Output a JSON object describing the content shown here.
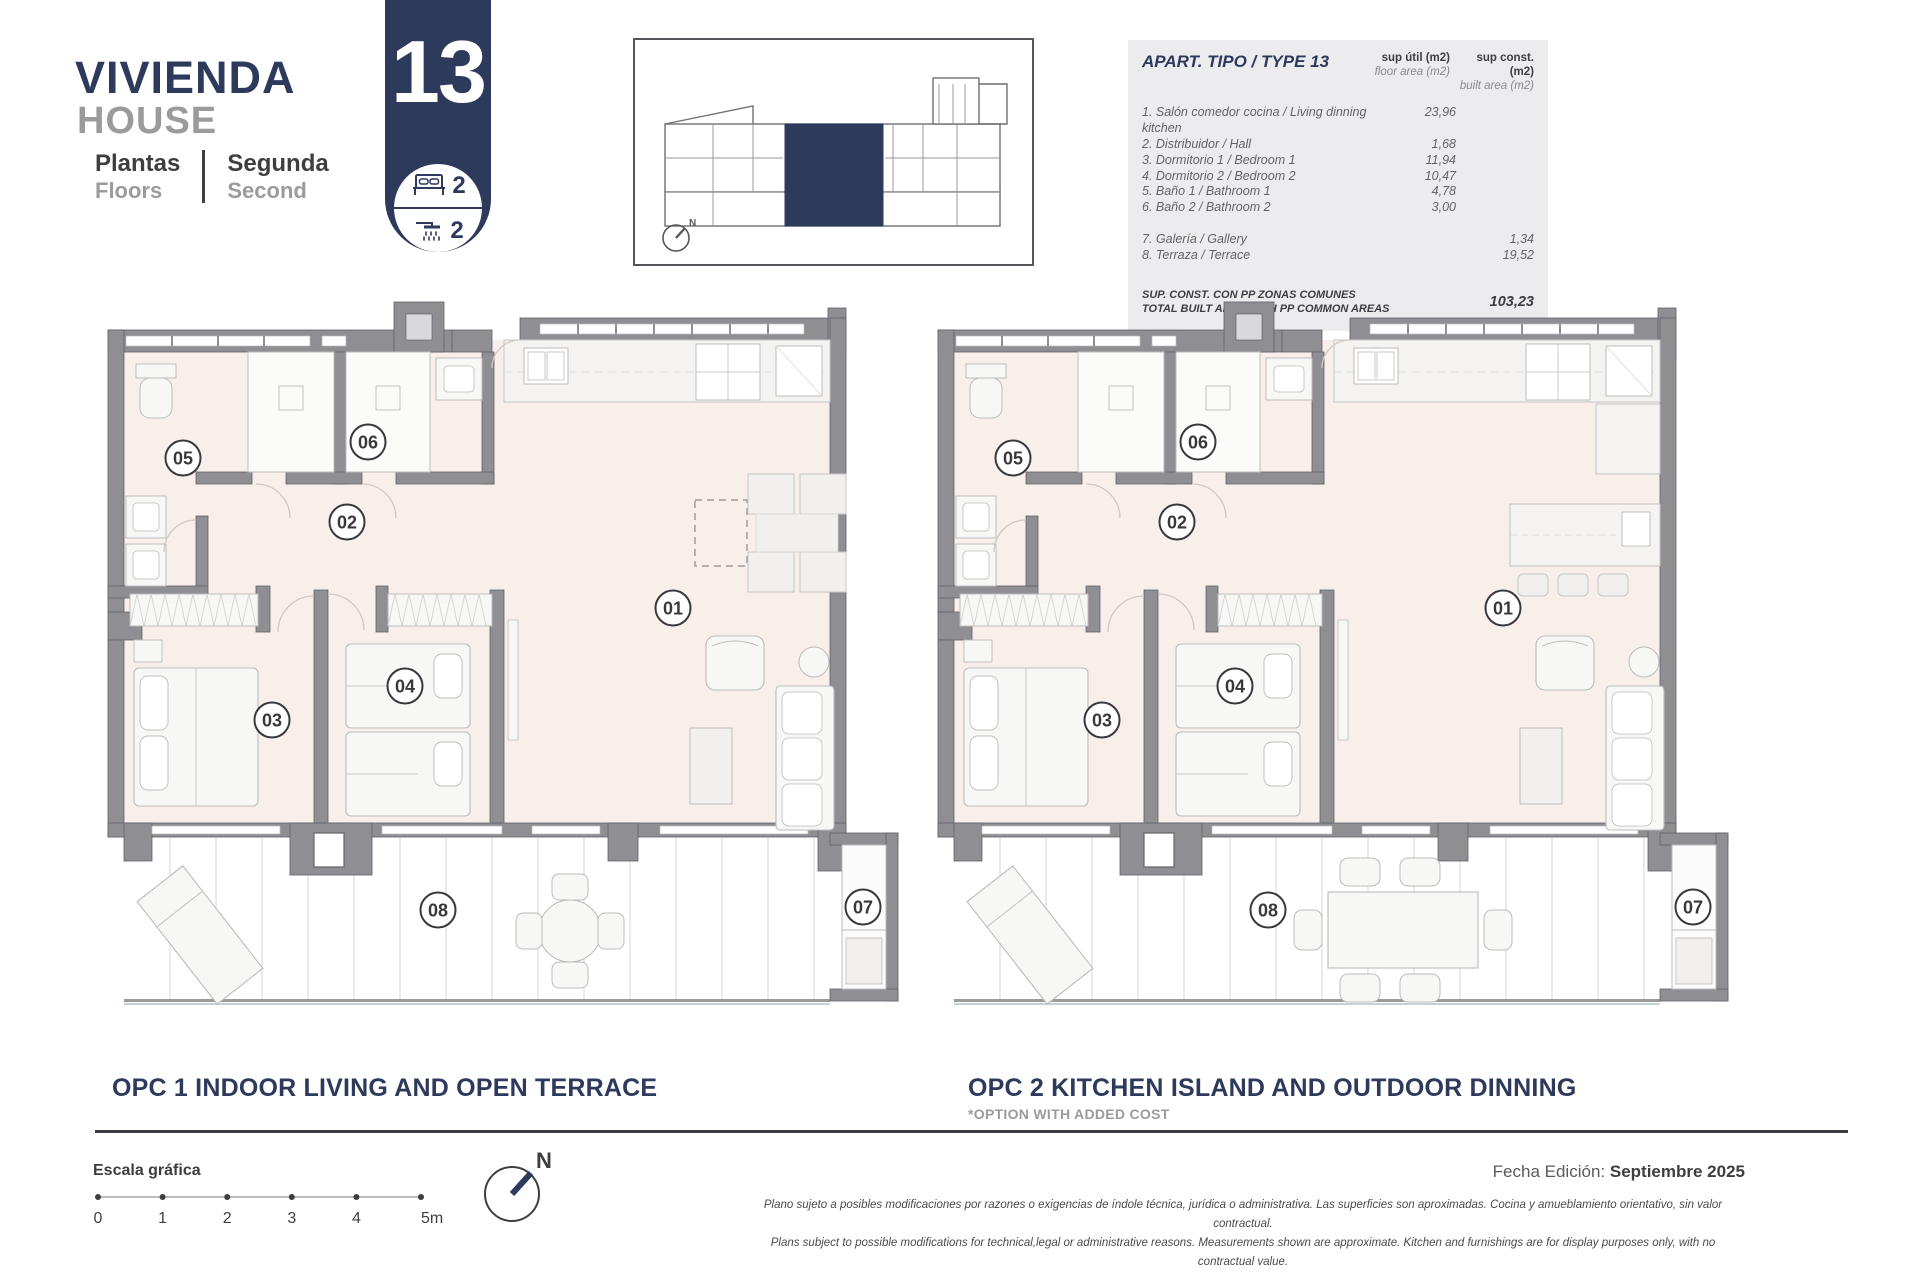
{
  "header": {
    "title_es": "VIVIENDA",
    "title_en": "HOUSE",
    "floors_label_es": "Plantas",
    "floors_label_en": "Floors",
    "floor_value_es": "Segunda",
    "floor_value_en": "Second",
    "unit_number": "13",
    "bedrooms": "2",
    "bathrooms": "2"
  },
  "area_table": {
    "title": "APART. TIPO / TYPE 13",
    "col1_label_es": "sup útil (m2)",
    "col1_label_en": "floor area (m2)",
    "col2_label_es": "sup const. (m2)",
    "col2_label_en": "built area (m2)",
    "rows": [
      {
        "label": "1. Salón comedor cocina / Living dinning kitchen",
        "floor_area": "23,96",
        "built_area": ""
      },
      {
        "label": "2. Distribuidor / Hall",
        "floor_area": "1,68",
        "built_area": ""
      },
      {
        "label": "3. Dormitorio 1 / Bedroom 1",
        "floor_area": "11,94",
        "built_area": ""
      },
      {
        "label": "4. Dormitorio 2 / Bedroom 2",
        "floor_area": "10,47",
        "built_area": ""
      },
      {
        "label": "5. Baño 1 / Bathroom 1",
        "floor_area": "4,78",
        "built_area": ""
      },
      {
        "label": "6. Baño 2 / Bathroom 2",
        "floor_area": "3,00",
        "built_area": ""
      },
      {
        "label": "7. Galería / Gallery",
        "floor_area": "",
        "built_area": "1,34"
      },
      {
        "label": "8. Terraza / Terrace",
        "floor_area": "",
        "built_area": "19,52"
      }
    ],
    "total_label_es": "SUP. CONST. CON PP ZONAS COMUNES",
    "total_label_en": "TOTAL BUILT AREA WITH PP COMMON AREAS",
    "total_value": "103,23"
  },
  "room_numbers": [
    "01",
    "02",
    "03",
    "04",
    "05",
    "06",
    "07",
    "08"
  ],
  "plans": [
    {
      "id": "opc1",
      "title": "OPC 1 INDOOR LIVING AND OPEN TERRACE",
      "subtitle": ""
    },
    {
      "id": "opc2",
      "title": "OPC 2 KITCHEN ISLAND AND OUTDOOR DINNING",
      "subtitle": "*OPTION WITH ADDED COST"
    }
  ],
  "scale_bar": {
    "label": "Escala gráfica",
    "ticks": [
      "0",
      "1",
      "2",
      "3",
      "4",
      "5m"
    ]
  },
  "compass_label": "N",
  "edition": {
    "label": "Fecha Edición:",
    "value": "Septiembre 2025"
  },
  "disclaimer": {
    "line1": "Plano sujeto a posibles modificaciones por razones o exigencias de índole técnica,  jurídica o administrativa. Las superficies son aproximadas. Cocina y amueblamiento orientativo, sin valor contractual.",
    "line2": "Plans subject to possible modifications for technical,legal or administrative reasons. Measurements shown are approximate. Kitchen and furnishings are for display purposes only, with no contractual value."
  },
  "colors": {
    "navy": "#2d3a5c",
    "gray_text": "#9b9b9b",
    "dark_text": "#3e3e40",
    "wall": "#8e8e93",
    "interior": "#f8efea",
    "table_bg": "#ececee"
  }
}
